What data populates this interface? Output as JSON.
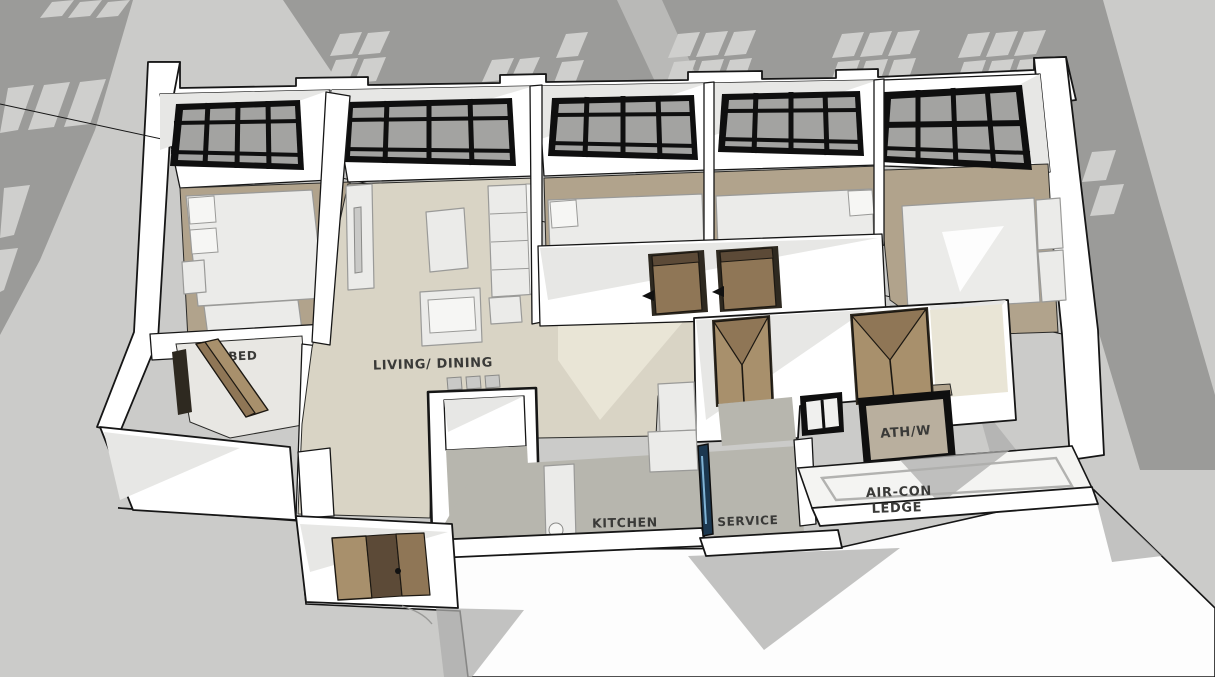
{
  "scene": {
    "type": "3d-floorplan-cutaway-render",
    "labels": {
      "living_dining": "LIVING/ DINING",
      "bedroom": "BED",
      "household_shelter": "HOUSE-",
      "kitchen": "KITCHEN",
      "service": "SERVICE",
      "aircon_line1": "AIR-CON",
      "aircon_line2": "LEDGE",
      "bath_wc": "ATH/W"
    }
  },
  "palette": {
    "bg": "#cbcbc9",
    "shadow": "#9b9b99",
    "shadowLight": "#b9b9b7",
    "stripe": "#cfcfcd",
    "ground": "#fdfdfd",
    "groundShadow": "#aeaeac",
    "wall": "#ffffff",
    "wallShade": "#e7e7e5",
    "wallShade2": "#dadad8",
    "outline": "#161616",
    "floorTan": "#b1a38c",
    "floorBeige": "#d9d4c5",
    "floorBeigeLight": "#e9e5d6",
    "floorGray": "#b7b6ae",
    "floorLight": "#e8e7e3",
    "furniture": "#ebebe9",
    "furnEdge": "#9a9a98",
    "doorLight": "#a8906c",
    "doorMid": "#8f7656",
    "doorDark": "#5c4a37",
    "frame": "#0f0f0f",
    "glass": "#a3a3a1",
    "glassBlue": "#1c3850",
    "glassBlueLight": "#7fb3d5",
    "text": "#3a3a38"
  }
}
